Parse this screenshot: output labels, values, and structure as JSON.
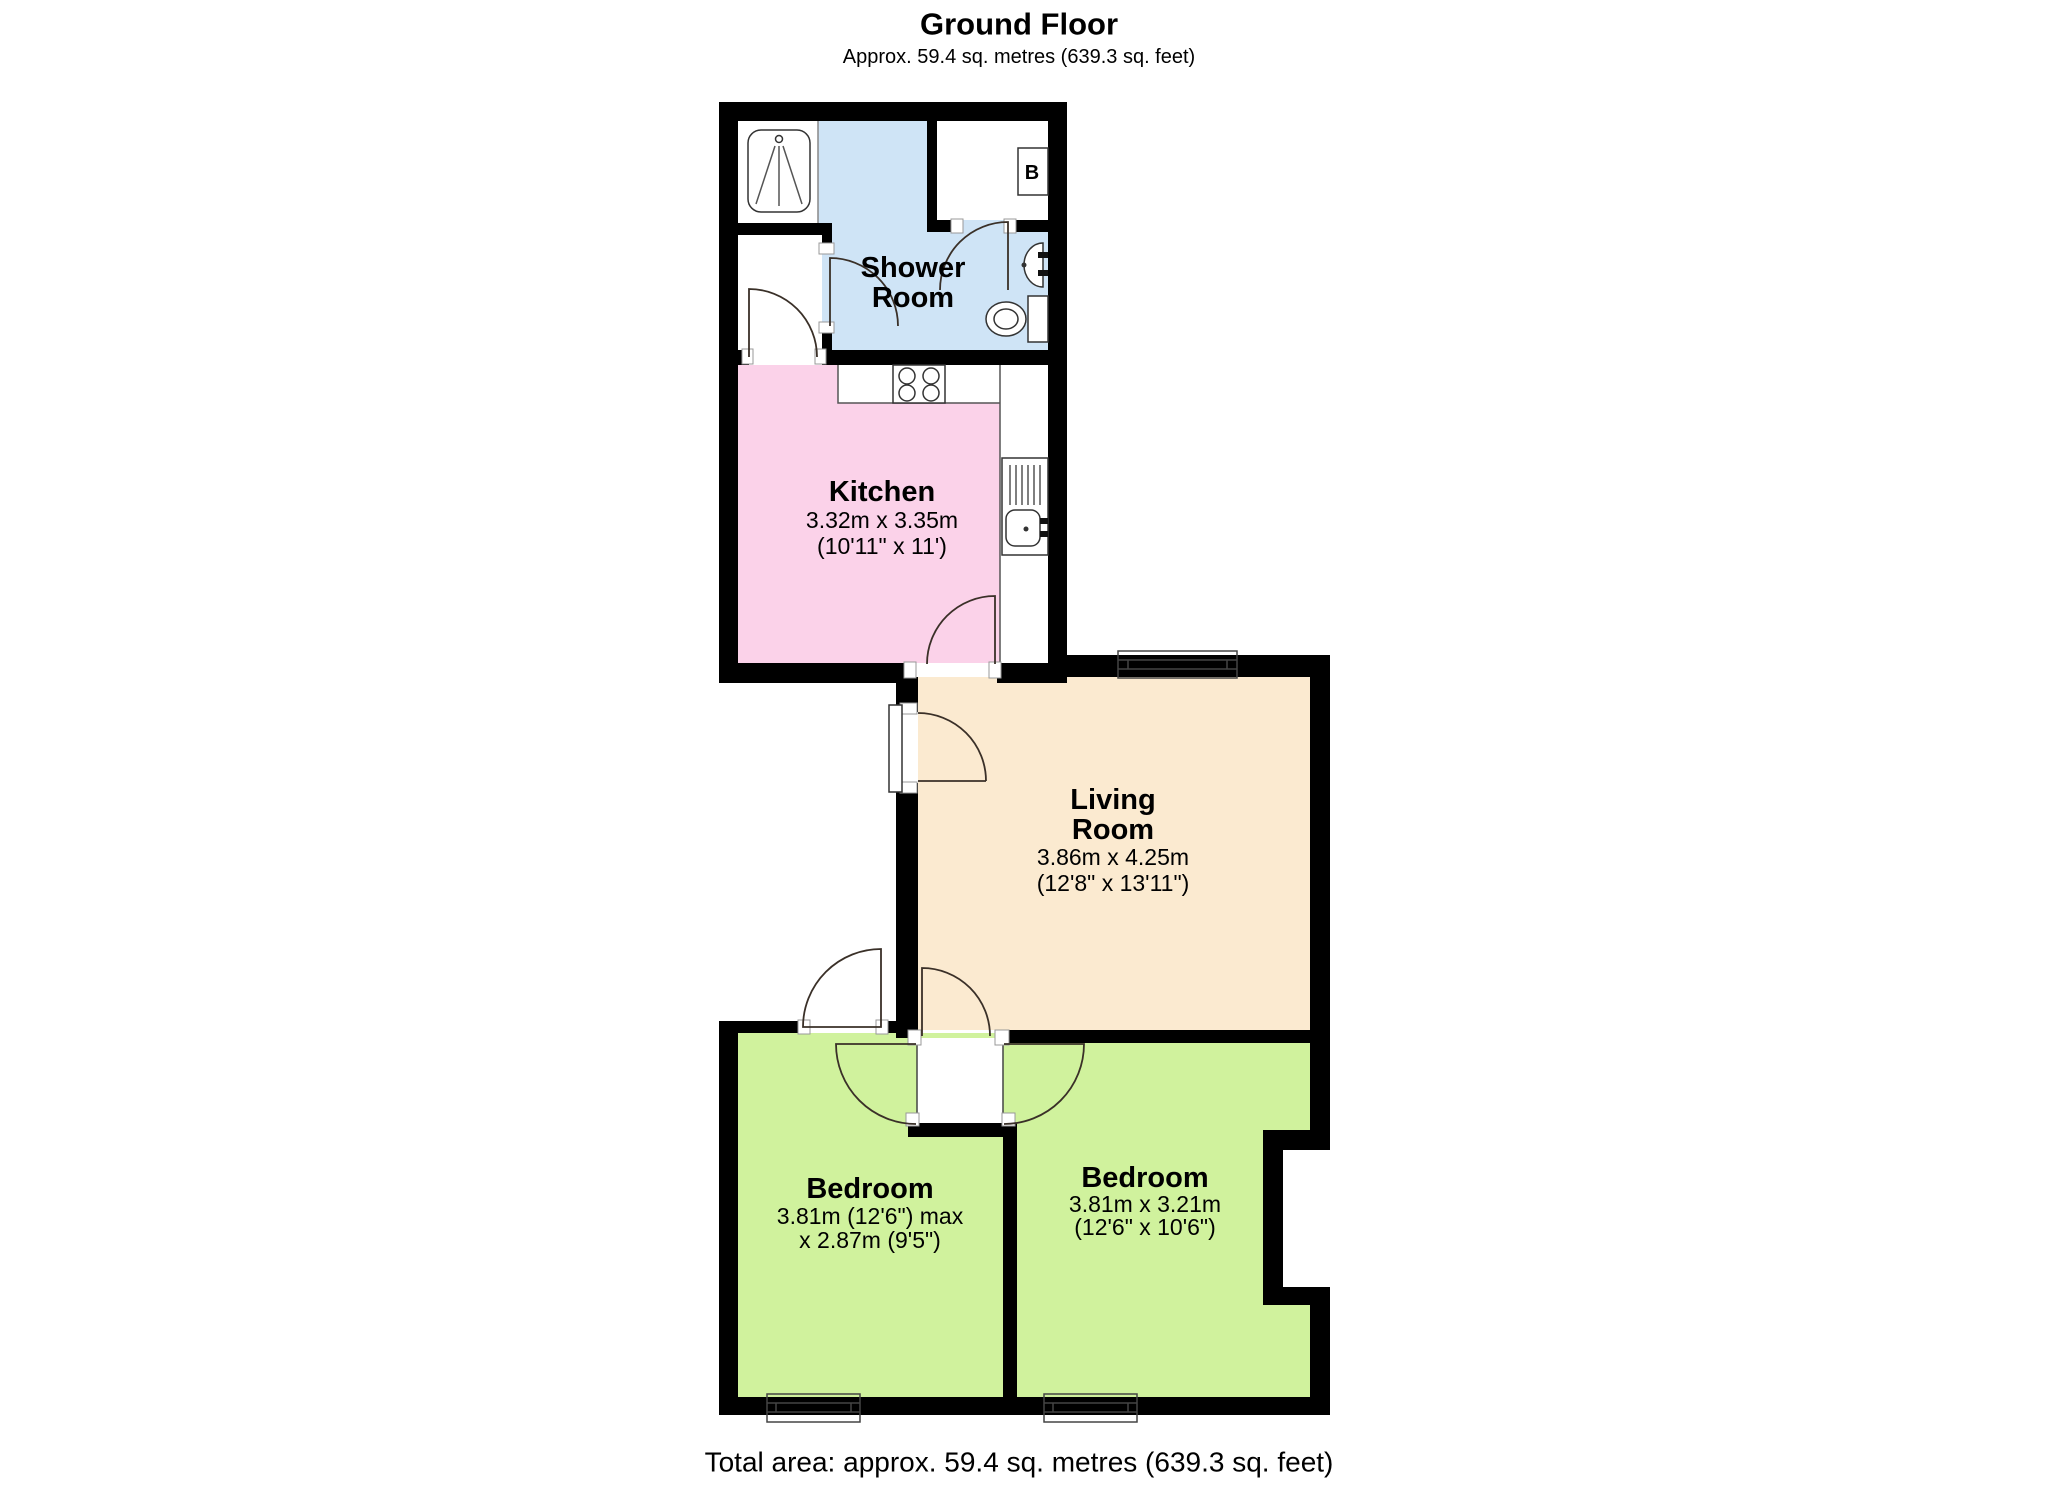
{
  "header": {
    "title": "Ground Floor",
    "subtitle": "Approx. 59.4 sq. metres (639.3 sq. feet)"
  },
  "footer": {
    "total_area": "Total area: approx. 59.4 sq. metres (639.3 sq. feet)"
  },
  "plan": {
    "wall_color": "#000000"
  },
  "rooms": {
    "shower_room": {
      "name_line1": "Shower",
      "name_line2": "Room",
      "color": "#cfe4f6"
    },
    "kitchen": {
      "name": "Kitchen",
      "dims_metric": "3.32m x 3.35m",
      "dims_imperial": "(10'11\" x 11')",
      "color": "#fbd2e9"
    },
    "living_room": {
      "name_line1": "Living",
      "name_line2": "Room",
      "dims_metric": "3.86m x 4.25m",
      "dims_imperial": "(12'8\" x 13'11\")",
      "color": "#fbead0"
    },
    "bedroom_left": {
      "name": "Bedroom",
      "dims_line1": "3.81m (12'6\") max",
      "dims_line2": "x 2.87m (9'5\")",
      "color": "#d0f29d"
    },
    "bedroom_right": {
      "name": "Bedroom",
      "dims_metric": "3.81m x 3.21m",
      "dims_imperial": "(12'6\" x 10'6\")",
      "color": "#d0f29d"
    }
  },
  "labels": {
    "boiler": "B"
  }
}
